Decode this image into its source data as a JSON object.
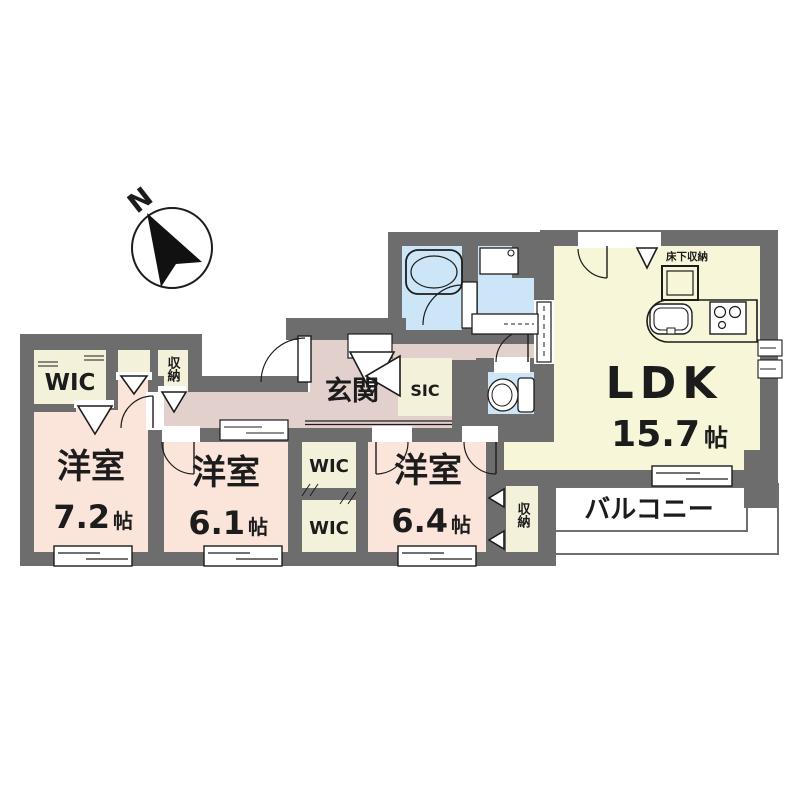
{
  "compass": {
    "north": "N"
  },
  "colors": {
    "wall": "#6d6d6d",
    "ldk": "#f8f6d8",
    "bedroom": "#fbe4da",
    "hall": "#e2d0cd",
    "wet": "#cde6f7",
    "closet": "#f4f1da"
  },
  "rooms": {
    "ldk": {
      "label": "LDK",
      "size_value": "15.7",
      "size_unit": "帖"
    },
    "bedroom1": {
      "label": "洋室",
      "size_value": "7.2",
      "size_unit": "帖"
    },
    "bedroom2": {
      "label": "洋室",
      "size_value": "6.1",
      "size_unit": "帖"
    },
    "bedroom3": {
      "label": "洋室",
      "size_value": "6.4",
      "size_unit": "帖"
    },
    "entrance": {
      "label": "玄関"
    },
    "balcony": {
      "label": "バルコニー"
    },
    "sic": {
      "label": "SIC"
    },
    "wic_main": {
      "label": "WIC"
    },
    "wic_upper": {
      "label": "WIC"
    },
    "wic_lower": {
      "label": "WIC"
    },
    "storage_hall": {
      "label": "収納"
    },
    "storage_bedroom3": {
      "label": "収納"
    },
    "underfloor_storage": {
      "label": "床下収納"
    }
  }
}
